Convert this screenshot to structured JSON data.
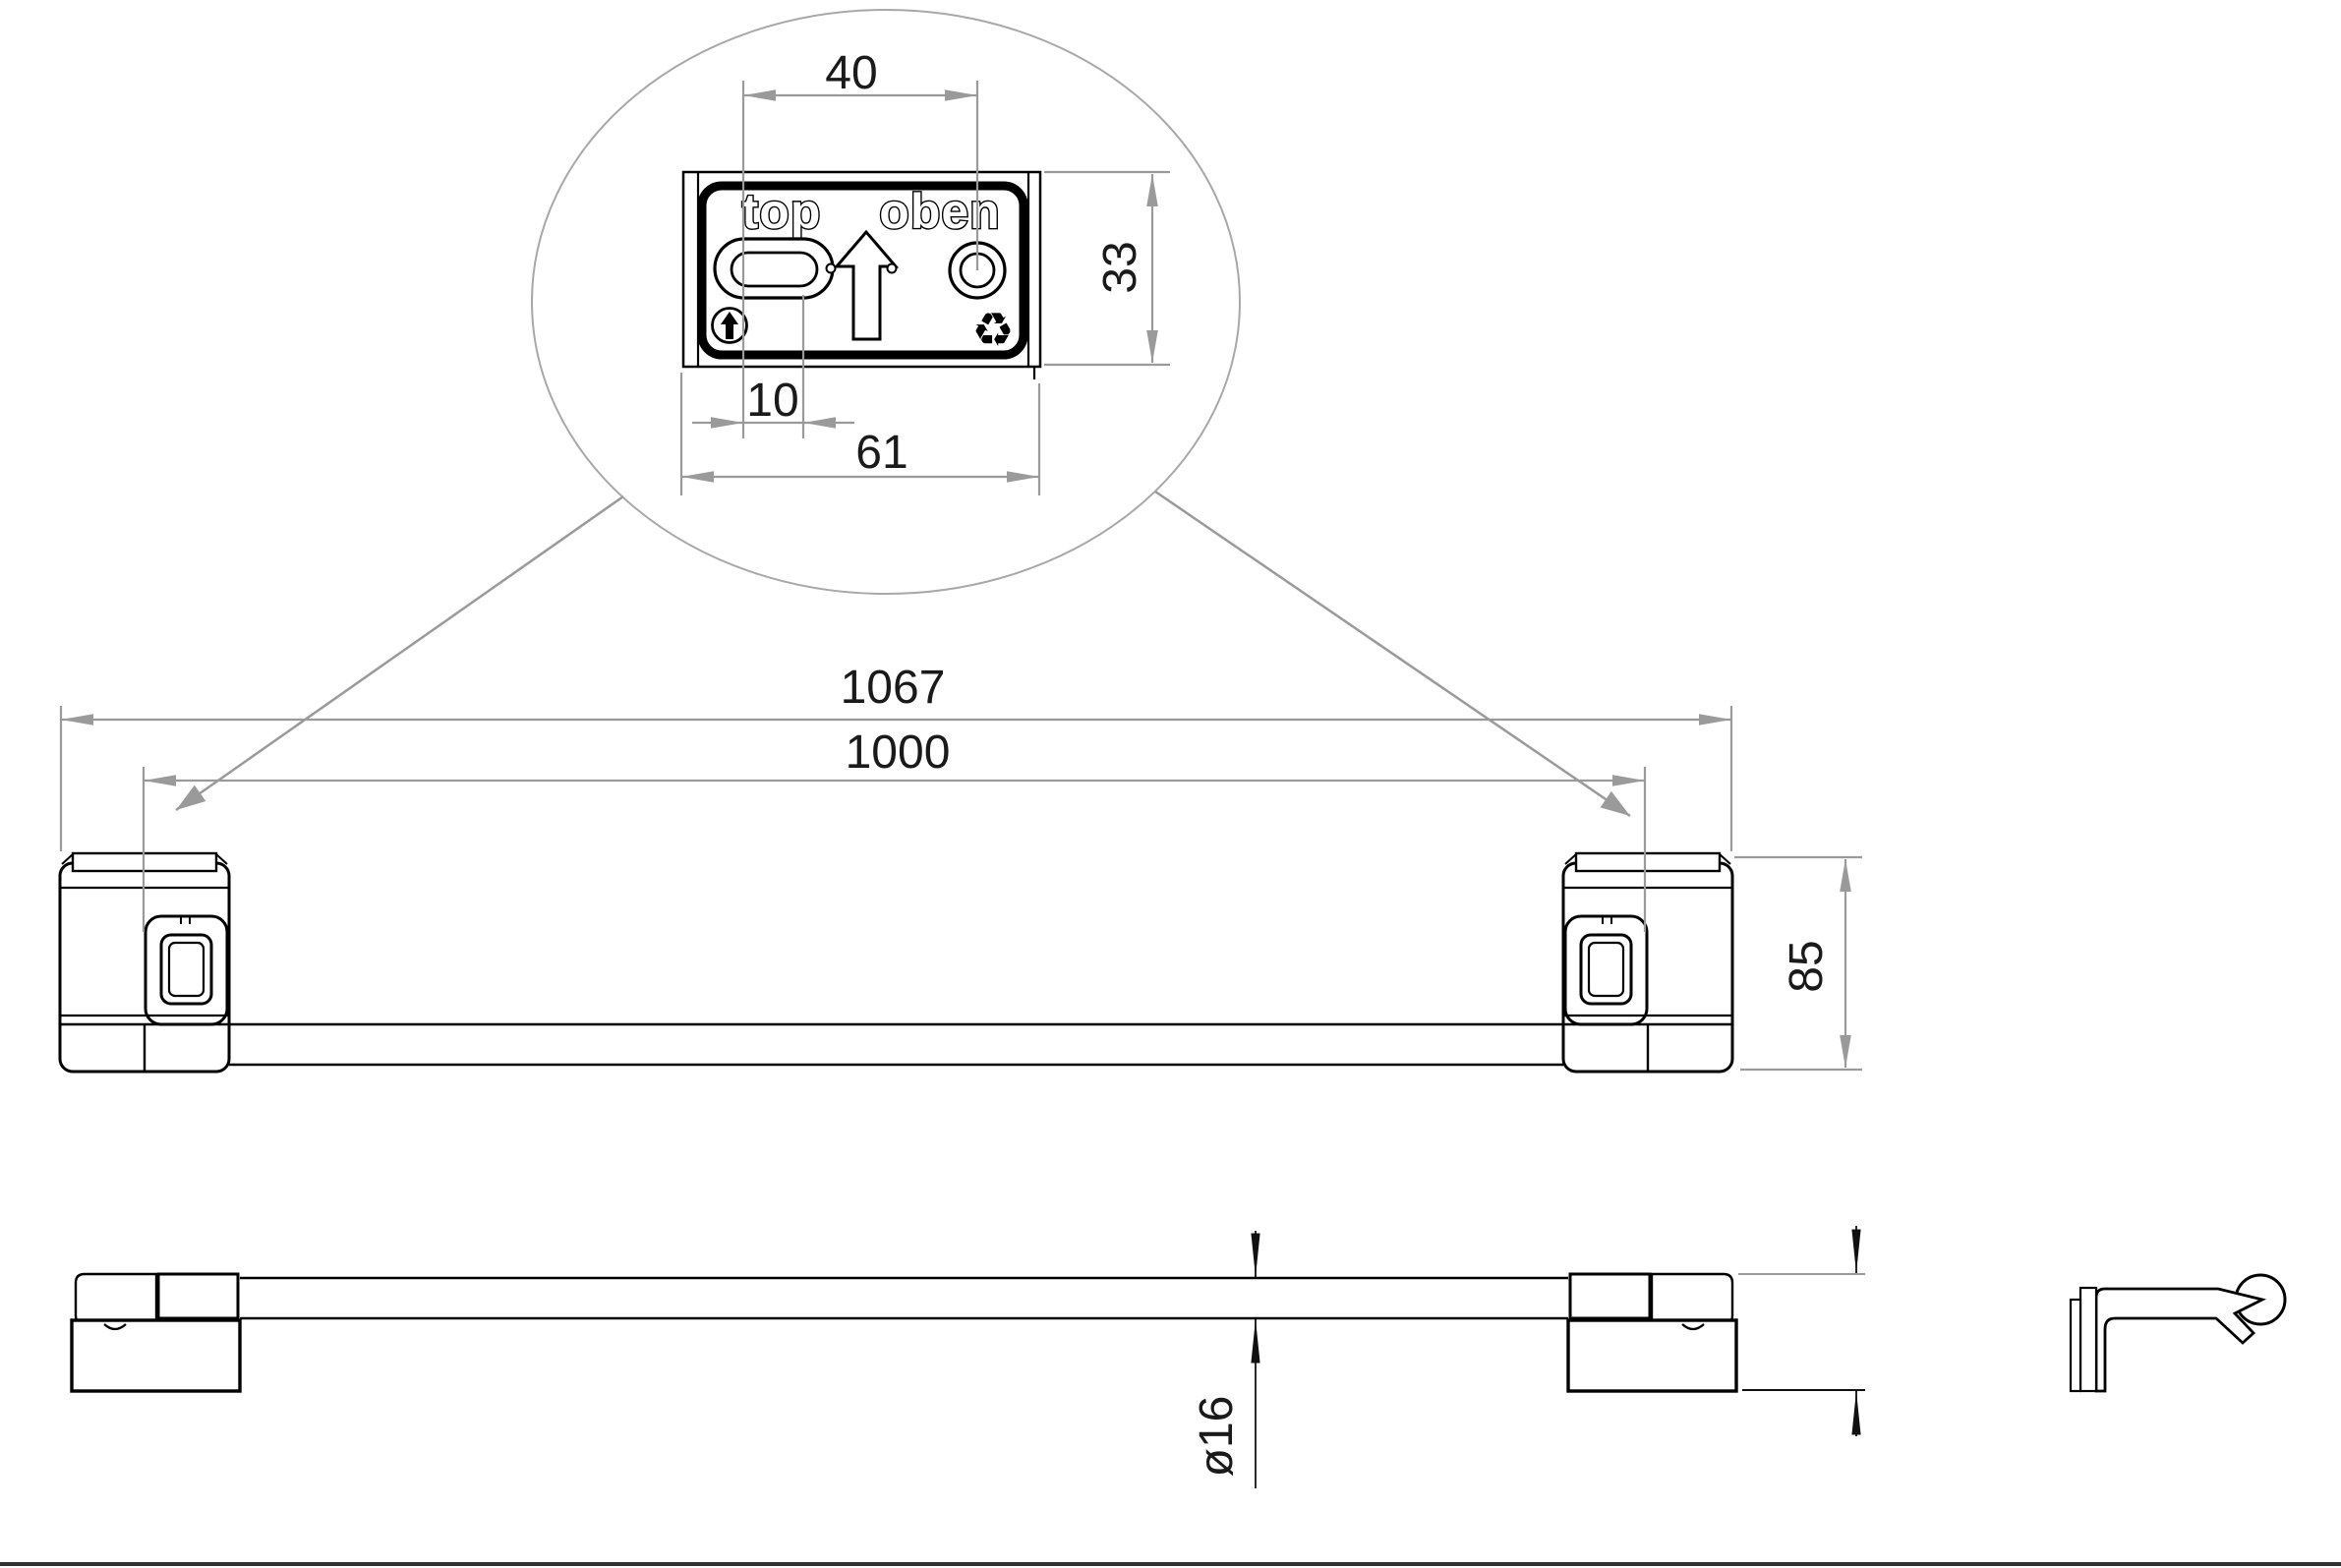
{
  "colors": {
    "part_line": "#000000",
    "dimension_gray": "#9a9a9a",
    "thin_dimension_black": "#111111",
    "text_ink": "#1a1a1a",
    "sheet_border": "#333333"
  },
  "detail_view": {
    "plate": {
      "label_left": "top",
      "label_right": "oben",
      "icons": {
        "orientation_arrow": "up-arrow-outline",
        "fastener_badge": "circled-up-arrow",
        "recycling_glyph": "♻"
      }
    },
    "dims": {
      "slot_to_hole": "40",
      "plate_height": "33",
      "slot_width": "10",
      "plate_width": "61"
    }
  },
  "front_view": {
    "dims": {
      "overall_width": "1067",
      "mounting_span": "1000",
      "bracket_height": "85"
    }
  },
  "top_view": {
    "dims": {
      "bar_diameter": "ø16"
    }
  },
  "side_view": {
    "description": "bracket-profile-with-bar-cross-section"
  }
}
